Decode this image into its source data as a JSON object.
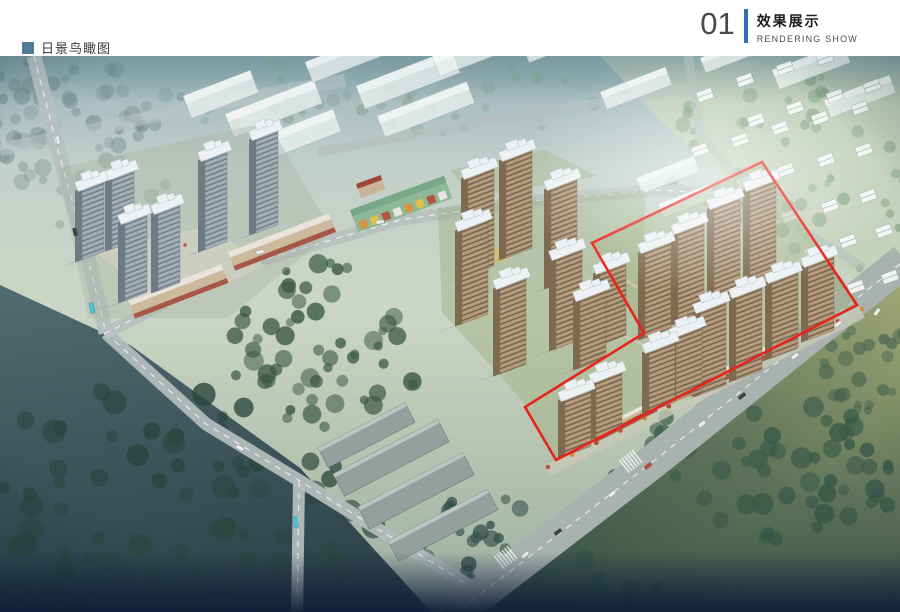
{
  "header": {
    "number": "01",
    "title_cn": "效果展示",
    "title_en": "RENDERING SHOW",
    "accent": "#2e74b5"
  },
  "caption": {
    "text": "日景鸟瞰图",
    "bullet_color": "#4e7d95"
  },
  "scene": {
    "fields": [
      {
        "name": "village-ground",
        "points": "600,56 900,56 900,305 745,200 660,120",
        "fill": "#c6d1b5",
        "opacity": 0.75
      },
      {
        "name": "southeast-meadow",
        "points": "438,616 905,252 905,616",
        "fill": "grad:olive",
        "opacity": 1
      },
      {
        "name": "southwest-forest-ground",
        "points": "0,285 130,345 300,468 435,616 0,616",
        "fill": "grad:darkleft",
        "opacity": 0.95
      }
    ],
    "forests": [
      {
        "cx": 60,
        "cy": 120,
        "rx": 85,
        "ry": 68,
        "n": 30,
        "color": "#5d7a78",
        "opacity": 0.45,
        "rmin": 4,
        "rmax": 9,
        "seed": 11
      },
      {
        "cx": 100,
        "cy": 150,
        "rx": 115,
        "ry": 80,
        "n": 38,
        "color": "#6c8a85",
        "opacity": 0.4,
        "rmin": 4,
        "rmax": 9,
        "seed": 21
      },
      {
        "cx": 400,
        "cy": 97,
        "rx": 205,
        "ry": 44,
        "n": 40,
        "color": "#7c9c80",
        "opacity": 0.45,
        "rmin": 3,
        "rmax": 7,
        "seed": 31
      },
      {
        "cx": 785,
        "cy": 180,
        "rx": 125,
        "ry": 115,
        "n": 55,
        "color": "#688f6c",
        "opacity": 0.5,
        "rmin": 3,
        "rmax": 8,
        "seed": 41
      },
      {
        "cx": 330,
        "cy": 345,
        "rx": 102,
        "ry": 82,
        "n": 55,
        "color": "#3c5a46",
        "opacity": 0.85,
        "rmin": 4,
        "rmax": 10,
        "seed": 51
      },
      {
        "cx": 150,
        "cy": 505,
        "rx": 235,
        "ry": 125,
        "n": 80,
        "color": "#2b463f",
        "opacity": 0.85,
        "rmin": 5,
        "rmax": 12,
        "seed": 61
      },
      {
        "cx": 760,
        "cy": 470,
        "rx": 150,
        "ry": 70,
        "n": 55,
        "color": "#395a49",
        "opacity": 0.85,
        "rmin": 5,
        "rmax": 11,
        "seed": 71
      },
      {
        "cx": 575,
        "cy": 595,
        "rx": 115,
        "ry": 42,
        "n": 35,
        "color": "#35524a",
        "opacity": 0.85,
        "rmin": 5,
        "rmax": 10,
        "seed": 81
      },
      {
        "cx": 480,
        "cy": 540,
        "rx": 70,
        "ry": 45,
        "n": 25,
        "color": "#33504a",
        "opacity": 0.8,
        "rmin": 4,
        "rmax": 9,
        "seed": 91
      },
      {
        "cx": 868,
        "cy": 372,
        "rx": 50,
        "ry": 55,
        "n": 25,
        "color": "#49664f",
        "opacity": 0.8,
        "rmin": 4,
        "rmax": 8,
        "seed": 101
      }
    ],
    "roads": [
      {
        "name": "far-road",
        "pts": [
          [
            0,
            150
          ],
          [
            200,
            106
          ],
          [
            345,
            80
          ]
        ],
        "w": 13,
        "color": "#b9c6c4",
        "opacity": 0.55,
        "dash": false
      },
      {
        "name": "north-road",
        "pts": [
          [
            318,
            152
          ],
          [
            540,
            112
          ],
          [
            693,
            88
          ]
        ],
        "w": 9,
        "color": "#b3bfbd",
        "opacity": 0.7,
        "dash": false
      },
      {
        "name": "northeast-road",
        "pts": [
          [
            688,
            56
          ],
          [
            700,
            135
          ],
          [
            762,
            205
          ],
          [
            864,
            268
          ]
        ],
        "w": 9,
        "color": "#b3bfbd",
        "opacity": 0.6,
        "dash": false
      },
      {
        "name": "west-road-upper",
        "pts": [
          [
            34,
            56
          ],
          [
            58,
            150
          ],
          [
            86,
            250
          ],
          [
            106,
            333
          ]
        ],
        "w": 15,
        "color": "#b6c0c0",
        "opacity": 0.95,
        "dash": true
      },
      {
        "name": "west-road-lower",
        "pts": [
          [
            106,
            333
          ],
          [
            206,
            424
          ],
          [
            300,
            481
          ],
          [
            480,
            592
          ]
        ],
        "w": 13,
        "color": "#b2bcba",
        "opacity": 0.95,
        "dash": true
      },
      {
        "name": "south-branch-road",
        "pts": [
          [
            299,
            481
          ],
          [
            297,
            616
          ]
        ],
        "w": 12,
        "color": "#b2bcba",
        "opacity": 0.95,
        "dash": true
      },
      {
        "name": "site-road",
        "pts": [
          [
            104,
            334
          ],
          [
            235,
            268
          ],
          [
            400,
            220
          ],
          [
            520,
            202
          ],
          [
            660,
            190
          ],
          [
            780,
            198
          ]
        ],
        "w": 12,
        "color": "#b8c1bf",
        "opacity": 0.95,
        "dash": true
      },
      {
        "name": "main-boulevard",
        "pts": [
          [
            452,
            616
          ],
          [
            655,
            460
          ],
          [
            905,
            260
          ]
        ],
        "w": 34,
        "color": "#a9b2ae",
        "opacity": 1,
        "dash": true
      }
    ],
    "slabs": [
      [
        183,
        96,
        72,
        24
      ],
      [
        225,
        114,
        95,
        25
      ],
      [
        247,
        142,
        92,
        24
      ],
      [
        305,
        62,
        80,
        22
      ],
      [
        356,
        86,
        102,
        25
      ],
      [
        377,
        116,
        96,
        23
      ],
      [
        432,
        56,
        86,
        22
      ],
      [
        522,
        44,
        80,
        20
      ],
      [
        600,
        92,
        70,
        19
      ],
      [
        700,
        58,
        60,
        16
      ],
      [
        636,
        178,
        62,
        17
      ],
      [
        658,
        204,
        56,
        15
      ],
      [
        772,
        70,
        76,
        21
      ],
      [
        824,
        100,
        70,
        19
      ]
    ],
    "warehouses": [
      [
        318,
        448,
        98,
        22
      ],
      [
        333,
        474,
        118,
        25
      ],
      [
        358,
        507,
        118,
        25
      ],
      [
        388,
        541,
        112,
        23
      ]
    ],
    "houses": [
      [
        705,
        95
      ],
      [
        745,
        80
      ],
      [
        785,
        68
      ],
      [
        825,
        58
      ],
      [
        756,
        120
      ],
      [
        795,
        108
      ],
      [
        835,
        96
      ],
      [
        872,
        86
      ],
      [
        700,
        150
      ],
      [
        740,
        140
      ],
      [
        780,
        128
      ],
      [
        820,
        118
      ],
      [
        860,
        108
      ],
      [
        745,
        182
      ],
      [
        786,
        170
      ],
      [
        826,
        160
      ],
      [
        864,
        150
      ],
      [
        790,
        216
      ],
      [
        830,
        206
      ],
      [
        868,
        196
      ],
      [
        812,
        252
      ],
      [
        848,
        241
      ],
      [
        884,
        231
      ],
      [
        856,
        287
      ],
      [
        890,
        277
      ]
    ],
    "parcels": [
      {
        "name": "left-parcel",
        "points": "58,168 268,122 332,232 228,318 88,318",
        "fill": "#aab4a4",
        "opacity": 0.4
      },
      {
        "name": "mid-parcel",
        "points": "438,208 645,190 642,332 527,406 442,312",
        "fill": "#9cad7c",
        "opacity": 0.42
      },
      {
        "name": "mid-north-strip",
        "points": "450,170 545,150 598,176 472,197",
        "fill": "#9cad7c",
        "opacity": 0.35
      },
      {
        "name": "zone-parcel",
        "points": "762,162 857,305 556,460 525,407 644,333 592,243",
        "fill": "#a0af7e",
        "opacity": 0.45
      }
    ],
    "plaza": {
      "points": "95,252 208,226 266,266 168,308",
      "fill": "#cfd0c2",
      "opacity": 0.8,
      "dots": [
        [
          120,
          270
        ],
        [
          140,
          262
        ],
        [
          160,
          252
        ],
        [
          185,
          245
        ],
        [
          205,
          238
        ],
        [
          135,
          290
        ]
      ]
    },
    "sidewalk": {
      "x1": 548,
      "y1": 470,
      "x2": 862,
      "y2": 312,
      "w": 13,
      "color": "#c8cab6",
      "opacity": 0.8,
      "tree_colors": [
        "#c1513a",
        "#d68a3f",
        "#b8432f"
      ],
      "n": 14
    },
    "retail": [
      {
        "kind": "tan",
        "x": 228,
        "y": 252,
        "w": 108,
        "h": 20,
        "rot": -21
      },
      {
        "kind": "tan",
        "x": 128,
        "y": 300,
        "w": 100,
        "h": 20,
        "rot": -21
      },
      {
        "kind": "green",
        "x": 350,
        "y": 210,
        "w": 100,
        "h": 24,
        "rot": -20
      },
      {
        "kind": "pavilion",
        "x": 356,
        "y": 184,
        "w": 26,
        "h": 15,
        "rot": -20
      },
      {
        "kind": "tan",
        "x": 590,
        "y": 432,
        "w": 70,
        "h": 12,
        "rot": -27
      },
      {
        "kind": "tan",
        "x": 700,
        "y": 380,
        "w": 80,
        "h": 12,
        "rot": -27
      }
    ],
    "shop_colors": [
      "#d9923f",
      "#e0c04a",
      "#b5533f",
      "#e8e8e0"
    ],
    "playgrounds": [
      [
        498,
        255,
        12,
        7
      ],
      [
        672,
        300,
        11,
        6
      ]
    ],
    "paths": [
      [
        [
          598,
          262
        ],
        [
          650,
          296
        ],
        [
          706,
          282
        ]
      ],
      [
        [
          612,
          330
        ],
        [
          668,
          356
        ],
        [
          718,
          338
        ]
      ]
    ],
    "towers": {
      "cool": [
        [
          82,
          188,
          72
        ],
        [
          112,
          177,
          72
        ],
        [
          125,
          221,
          80
        ],
        [
          158,
          211,
          80
        ],
        [
          205,
          158,
          92
        ],
        [
          256,
          137,
          96
        ]
      ],
      "warm": [
        [
          468,
          176,
          100
        ],
        [
          506,
          158,
          100
        ],
        [
          462,
          228,
          96
        ],
        [
          500,
          286,
          88
        ],
        [
          551,
          187,
          100
        ],
        [
          556,
          257,
          92
        ],
        [
          580,
          298,
          70
        ],
        [
          600,
          271,
          74
        ],
        [
          645,
          250,
          88
        ],
        [
          678,
          231,
          92
        ],
        [
          714,
          206,
          96
        ],
        [
          750,
          188,
          96
        ],
        [
          700,
          310,
          85
        ],
        [
          736,
          295,
          85
        ],
        [
          772,
          280,
          78
        ],
        [
          808,
          264,
          76
        ],
        [
          649,
          350,
          62
        ],
        [
          676,
          335,
          66
        ],
        [
          565,
          398,
          58
        ],
        [
          596,
          380,
          58
        ]
      ]
    },
    "tower_style": {
      "cool": {
        "w": 22,
        "face": "#a3aeb6",
        "line": "#72808a",
        "side": "#6e7a84"
      },
      "warm": {
        "w": 26,
        "face": "#b59c7e",
        "line": "#77644c",
        "side": "#7e6a50"
      },
      "roof": "#eef1f3",
      "roof_edge": "#b6c0c4",
      "shadow": "#1e3a34"
    },
    "cars": [
      [
        525,
        555,
        -38,
        "#eceeee"
      ],
      [
        558,
        532,
        -38,
        "#3c4248"
      ],
      [
        612,
        494,
        -38,
        "#eceeee"
      ],
      [
        648,
        466,
        -38,
        "#c04a3a"
      ],
      [
        702,
        424,
        -38,
        "#eceeee"
      ],
      [
        742,
        396,
        -38,
        "#3c4248"
      ],
      [
        795,
        356,
        -38,
        "#eceeee"
      ],
      [
        838,
        324,
        -38,
        "#eceeee"
      ],
      [
        877,
        312,
        -52,
        "#eceeee"
      ],
      [
        58,
        140,
        76,
        "#eceeee"
      ],
      [
        75,
        232,
        76,
        "#3c4248"
      ],
      [
        260,
        252,
        -16,
        "#eceeee"
      ],
      [
        380,
        222,
        -8,
        "#eceeee"
      ],
      [
        240,
        448,
        31,
        "#eceeee"
      ]
    ],
    "buses": [
      [
        92,
        308,
        76
      ],
      [
        296,
        522,
        89
      ]
    ],
    "bus_color": "#49c2d4",
    "zebras": [
      [
        630,
        462,
        -38
      ],
      [
        505,
        558,
        -38
      ]
    ],
    "red_outline": {
      "points": "762,162 857,305 556,460 525,407 644,333 592,243",
      "color": "#e8231c",
      "width": 2.6
    }
  }
}
